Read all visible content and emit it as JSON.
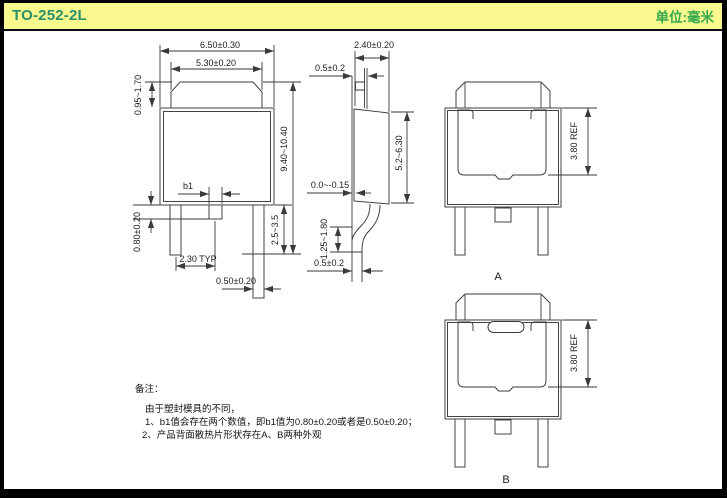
{
  "header": {
    "title": "TO-252-2L",
    "unit_label": "单位:毫米"
  },
  "colors": {
    "header_bg": "#F8F88E",
    "title_green": "#2E8F66",
    "unit_green": "#36A94C",
    "line": "#3a3a3a"
  },
  "front_view": {
    "dim_overall_width": "6.50±0.30",
    "dim_tab_width": "5.30±0.20",
    "dim_tab_height": "0.95~1.70",
    "dim_total_height": "9.40~10.40",
    "dim_mid_pin_label": "b1",
    "dim_mid_pin_length": "0.80±0.20",
    "dim_pin_pitch": "2.30 TYP",
    "dim_pin_width": "0.50±0.20",
    "dim_pin_length": "2.5~3.5"
  },
  "side_view": {
    "dim_body_thickness": "2.40±0.20",
    "dim_tab_thickness": "0.5±0.2",
    "dim_body_height": "5.2~6.30",
    "dim_standoff": "0.0~-0.15",
    "dim_lead_foot_height": "1.25~1.80",
    "dim_lead_thickness": "0.5±0.2"
  },
  "back_view_a": {
    "label": "A",
    "dim_pad_height": "3.80 REF"
  },
  "back_view_b": {
    "label": "B",
    "dim_pad_height": "3.80 REF"
  },
  "notes": {
    "heading": "备注：",
    "intro": "由于塑封模具的不同，",
    "item1": "1、b1值会存在两个数值，即b1值为0.80±0.20或者是0.50±0.20；",
    "item2": "2、产品背面散热片形状存在A、B两种外观"
  }
}
